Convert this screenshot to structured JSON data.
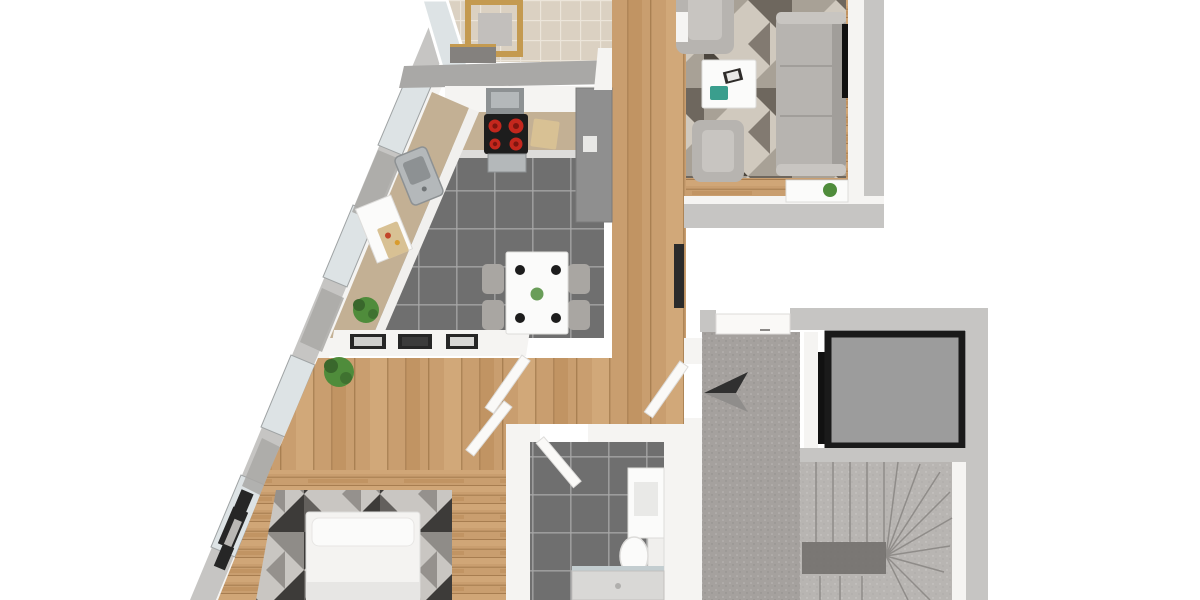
{
  "meta": {
    "title": "3D rendered apartment floor plan, isometric top-down view",
    "view": "top-down 3D dollhouse render",
    "visible_text": "none"
  },
  "palette": {
    "bg": "#ffffff",
    "wood": "#c99e6f",
    "woodDark": "#b3854f",
    "woodLight": "#dcb586",
    "tile": "#6f6f6f",
    "tileLine": "#a8a8a8",
    "btile": "#dbd1c2",
    "btileLine": "#ece5da",
    "wallOuter": "#c6c5c3",
    "wallCap2": "#a9a8a6",
    "wallWhite": "#f5f4f2",
    "wallShade": "#dddcda",
    "glass": "#dde3e5",
    "carpet": "#a5a19e",
    "stairs": "#b8b5b2",
    "stairLine": "#8f8c89",
    "stairShadow": "#6f6c69",
    "elevFill": "#9c9c9c",
    "elevFrame": "#1a1a1a",
    "sofa": "#b7b4b0",
    "sofaShade": "#a19e9a",
    "sofaLight": "#c8c5c1",
    "rugA": "#d0c9be",
    "rugB": "#a8a196",
    "rugC": "#6e675e",
    "rugD": "#4c463e",
    "brugA": "#c9c6c2",
    "brugB": "#8f8c88",
    "brugC": "#3d3b39",
    "brugD": "#63605d",
    "bed": "#f4f3f1",
    "bedShade": "#e7e6e4",
    "white": "#fbfbfa",
    "plant": "#4f8c3b",
    "plantDark": "#39672c",
    "teal": "#3a9e8d",
    "burner": "#c4271d",
    "burnerDark": "#7e150f",
    "stove": "#1d1d1d",
    "steel": "#b4b8ba",
    "steelDark": "#8d9193",
    "counter": "#c3b094",
    "board": "#d8c194",
    "chairWood": "#c49a50",
    "chairGray": "#a9a6a2",
    "arrowDark": "#303030",
    "arrowLight": "#8f8d8b",
    "frameDark": "#262626",
    "doorWhite": "#faf9f7",
    "black": "#111111"
  },
  "rooms": [
    {
      "name": "balcony",
      "floor": "beige tile",
      "furniture": [
        "wooden chair with gray cushion",
        "low bench",
        "glass railing"
      ]
    },
    {
      "name": "kitchen",
      "floor": "dark gray tile",
      "furniture": [
        "corner counter",
        "stainless sink",
        "cooktop with 4 red burners",
        "range hood",
        "oven",
        "tall fridge unit",
        "cutting boards",
        "dining table for 4",
        "4 gray chairs",
        "potted plant",
        "3 framed pictures on wall"
      ]
    },
    {
      "name": "living-room",
      "floor": "oak wood",
      "furniture": [
        "3-seat gray sofa",
        "2 gray armchairs",
        "white coffee table with books and teal notebook",
        "geometric triangle rug",
        "wall-mounted TV",
        "sideboard with plant"
      ]
    },
    {
      "name": "hallway",
      "floor": "oak wood",
      "furniture": [
        "potted plant",
        "radiator",
        "3 interior doors"
      ]
    },
    {
      "name": "bedroom",
      "floor": "oak wood",
      "furniture": [
        "double bed with white duvet",
        "dark geometric rug",
        "3 framed pictures on wall"
      ]
    },
    {
      "name": "bathroom",
      "floor": "dark gray tile",
      "furniture": [
        "vanity cabinet",
        "toilet",
        "shower tray"
      ]
    },
    {
      "name": "stair-landing",
      "floor": "gray carpet",
      "furniture": [
        "entrance direction arrow",
        "apartment entry door"
      ]
    },
    {
      "name": "elevator",
      "floor": "gray cab",
      "furniture": [
        "elevator car",
        "black shaft gap"
      ]
    },
    {
      "name": "staircase",
      "floor": "gray carpet steps",
      "furniture": [
        "straight flight",
        "winder steps",
        "white stringer"
      ]
    }
  ]
}
